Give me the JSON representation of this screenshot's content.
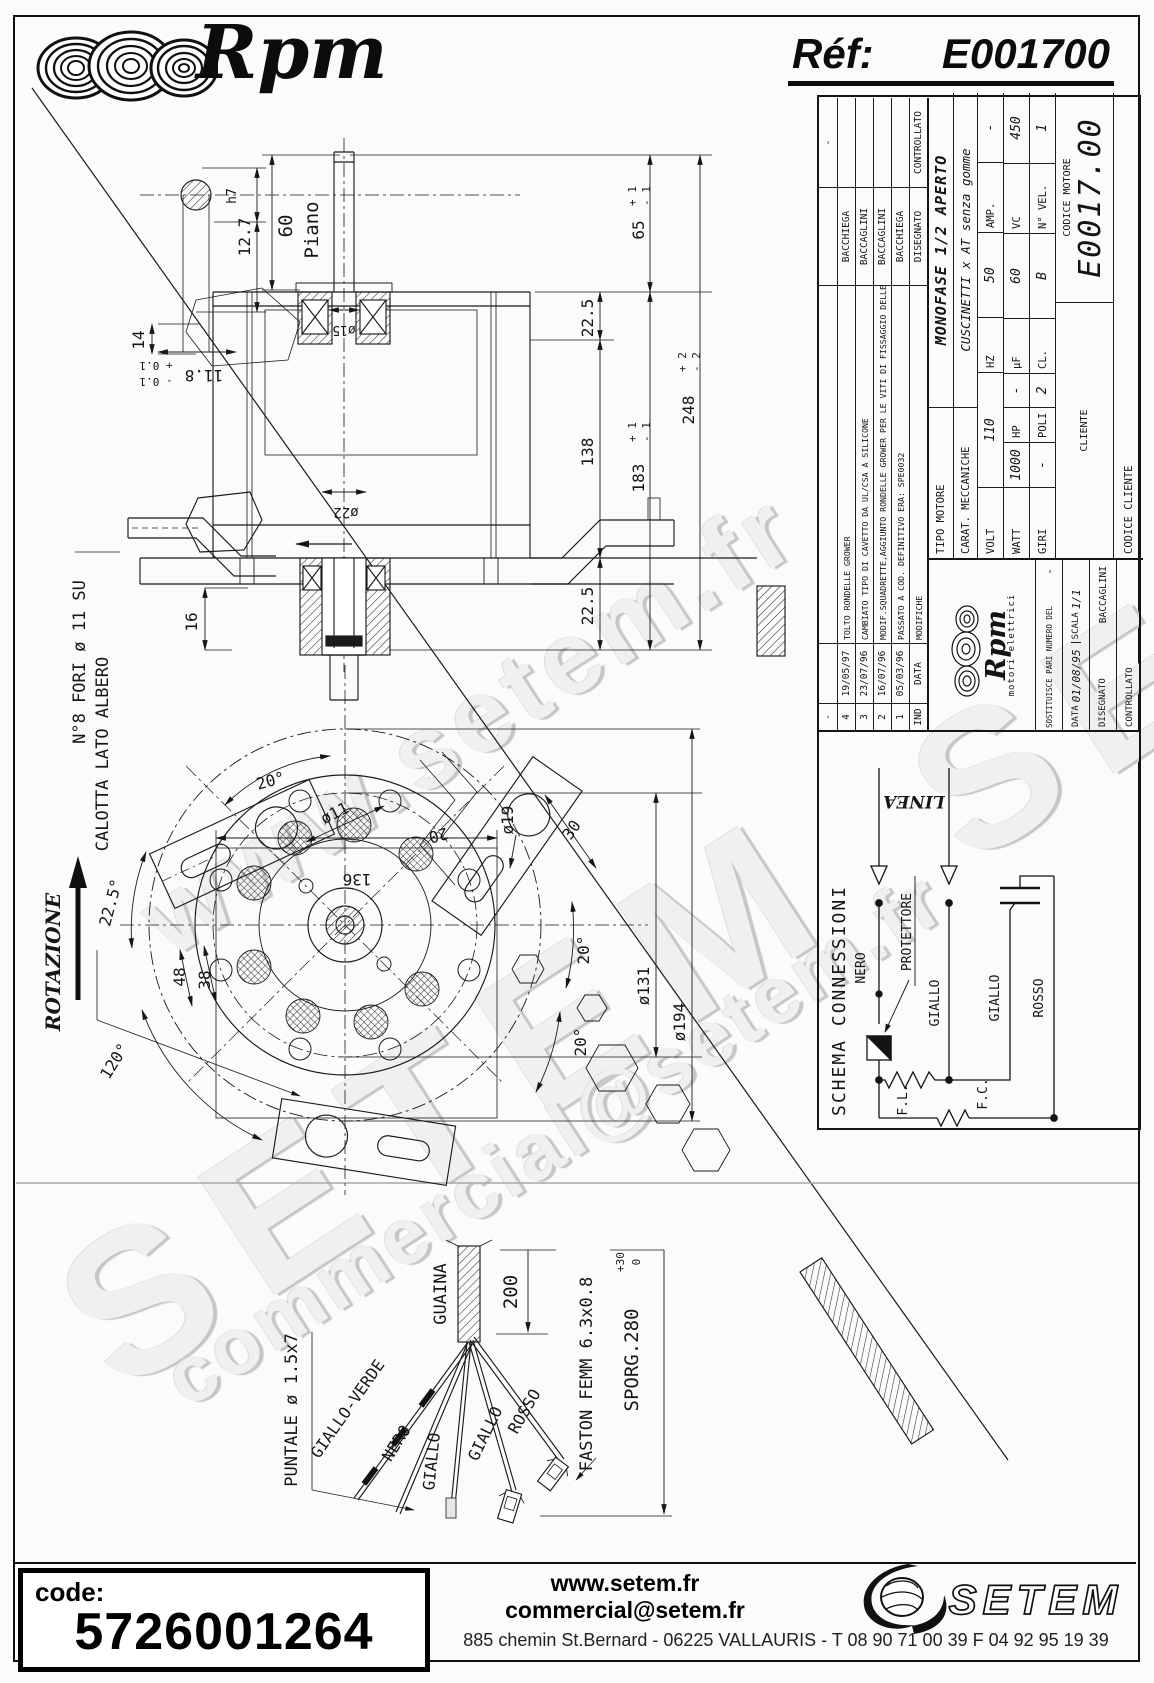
{
  "header": {
    "brand": "Rpm",
    "ref_label": "Réf:",
    "ref_value": "E001700"
  },
  "watermarks": {
    "site": "www.setem.fr",
    "brand": "SETEM",
    "email": "commercial@setem.fr"
  },
  "drawing": {
    "notes": {
      "fori": "N°8 FORI ø 11 SU",
      "calotta": "CALOTTA LATO ALBERO",
      "rotazione": "ROTAZIONE"
    },
    "dims": {
      "d12_7": "12.7",
      "h7": "h7",
      "d11_8": "11.8",
      "t11_8p": "+ 0.1",
      "t11_8m": "- 0.1",
      "d60": "60",
      "piano": "Piano",
      "d14": "14",
      "d16": "16",
      "d15": "ø15",
      "d22": "ø22",
      "d22_5_top": "22.5",
      "d138": "138",
      "d22_5_bot": "22.5",
      "d65": "65",
      "t65p": "+ 1",
      "t65m": "- 1",
      "d183": "183",
      "t183p": "+ 1",
      "t183m": "- 1",
      "d248": "248",
      "t248p": "+ 2",
      "t248m": "- 2",
      "d136": "136",
      "a20_top": "20°",
      "n20": "20",
      "d11": "ø11",
      "d19": "ø19",
      "d30": "30",
      "a20_a": "20°",
      "a20_b": "20°",
      "d131": "ø131",
      "d194": "ø194",
      "a22_5": "22.5°",
      "d48": "48",
      "d38": "38",
      "a120": "120°"
    },
    "cable": {
      "guaina": "GUAINA",
      "d200": "200",
      "faston": "FASTON FEMM 6.3x0.8",
      "sporg": "SPORG.280",
      "sporg_p": "+30",
      "sporg_m": "0",
      "puntale": "PUNTALE ø 1.5x7",
      "w_gv": "GIALLO-VERDE",
      "w_nero": "NERO",
      "w_g1": "GIALLO",
      "w_g2": "GIALLO",
      "w_rosso": "ROSSO"
    }
  },
  "title_block": {
    "revisions": [
      {
        "ind": "-",
        "date": "",
        "text": "",
        "by": "",
        "ctrl": "-"
      },
      {
        "ind": "4",
        "date": "19/05/97",
        "text": "TOLTO RONDELLE GROWER",
        "by": "BACCHIEGA",
        "ctrl": ""
      },
      {
        "ind": "3",
        "date": "23/07/96",
        "text": "CAMBIATO TIPO DI CAVETTO DA UL/CSA A SILICONE",
        "by": "BACCAGLINI",
        "ctrl": ""
      },
      {
        "ind": "2",
        "date": "16/07/96",
        "text": "MODIF.SQUADRETTE,AGGIUNTO RONDELLE GROWER PER LE VITI DI FISSAGGIO DELLE STESSE",
        "by": "BACCAGLINI",
        "ctrl": ""
      },
      {
        "ind": "1",
        "date": "05/03/96",
        "text": "PASSATO A COD. DEFINITIVO ERA: SPE0032",
        "by": "BACCHIEGA",
        "ctrl": ""
      },
      {
        "ind": "IND",
        "date": "DATA",
        "text": "MODIFICHE",
        "by": "DISEGNATO",
        "ctrl": "CONTROLLATO"
      }
    ],
    "logo": {
      "brand": "Rpm",
      "sub": "motori elettrici"
    },
    "admin": {
      "sost_label": "SOSTITUISCE PARI NUMERO DEL",
      "sost_value": "-",
      "data_label": "DATA",
      "data_value": "01/08/95",
      "scala_label": "SCALA",
      "scala_value": "1/1",
      "disegnato_label": "DISEGNATO",
      "disegnato_value": "BACCAGLINI",
      "controllato_label": "CONTROLLATO"
    },
    "specs": {
      "tipo_label": "TIPO MOTORE",
      "tipo_value": "MONOFASE 1/2 APERTO",
      "carat_label": "CARAT. MECCANICHE",
      "carat_value": "CUSCINETTI x AT senza gomme",
      "volt_label": "VOLT",
      "volt_value": "110",
      "hz_label": "HZ",
      "hz_value": "50",
      "amp_label": "AMP.",
      "amp_value": "-",
      "watt_label": "WATT",
      "watt_value": "1000",
      "hp_label": "HP",
      "hp_value": "-",
      "uf_label": "µF",
      "uf_value": "60",
      "vc_label": "VC",
      "vc_value": "450",
      "giri_label": "GIRI",
      "giri_value": "-",
      "poli_label": "POLI",
      "poli_value": "2",
      "cl_label": "CL.",
      "cl_value": "B",
      "nvel_label": "N° VEL.",
      "nvel_value": "1",
      "cliente_label": "CLIENTE",
      "codice_motore_label": "CODICE MOTORE",
      "codice_motore_value": "E0017.00",
      "codice_cliente_label": "CODICE CLIENTE"
    },
    "schema": {
      "title": "SCHEMA CONNESSIONI",
      "linea": "LINEA",
      "nero": "NERO",
      "protettore": "PROTETTORE",
      "giallo_1": "GIALLO",
      "giallo_2": "GIALLO",
      "rosso": "ROSSO",
      "fl": "F.L.",
      "fc": "F.C."
    }
  },
  "footer": {
    "code_label": "code:",
    "code_value": "5726001264",
    "site": "www.setem.fr",
    "email": "commercial@setem.fr",
    "brand": "SETEM",
    "address": "885 chemin St.Bernard  -  06225 VALLAURIS  -  T 08 90 71 00 39   F 04 92 95 19 39"
  }
}
